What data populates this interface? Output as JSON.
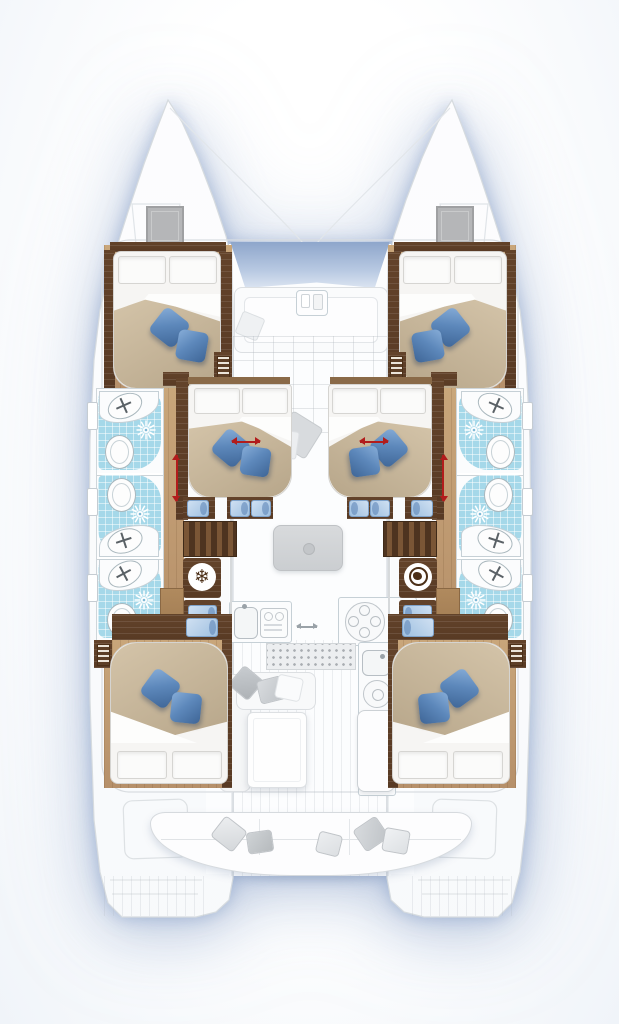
{
  "diagram": {
    "type": "floor-plan",
    "subject": "catamaran-yacht-deck-plan",
    "view": "top-down"
  },
  "palette": {
    "deck_white": "#fcfdfe",
    "outline_gray": "#d5d9dd",
    "shadow_blue": "#7a94c1",
    "wood_light": "#c0996f",
    "wood_dark": "#5d3f27",
    "bathroom_blue": "#a5d8e9",
    "duvet_beige": "#c4b296",
    "pillow_blue": "#5d88bb",
    "step_pad_blue": "#aecbe7",
    "arrow_red": "#b21c1c",
    "front_window_blue": "#93a9cd",
    "faded_furniture_gray": "#d7dadd",
    "hatch_gray": "#b3b4b6"
  },
  "icons": {
    "fridge_glyph": "❄",
    "list": [
      "snowflake-icon",
      "washer-icon",
      "shower-head-icon",
      "sink-faucet-icon",
      "toilet-icon",
      "louver-vent-icon"
    ]
  },
  "counts": {
    "hulls": 2,
    "cabins_with_double_beds": 6,
    "bathrooms": 6,
    "shower_icons": 6,
    "toilets": 6,
    "sinks": 6,
    "blue_pillows_per_bed": 2,
    "red_convert_arrows": 4,
    "companionway_stairs": 2
  },
  "areas": {
    "bow": [
      "port-bow-deck",
      "starboard-bow-deck",
      "trampoline-gap"
    ],
    "forward": [
      "forward-cockpit-lounge",
      "coachroof-front-window"
    ],
    "port_hull": [
      "forward-cabin",
      "three-bathrooms",
      "mid-cabin",
      "stairs",
      "fridge-freezer-cabinet",
      "drawer-cabinet",
      "aft-cabin"
    ],
    "starboard_hull": [
      "forward-cabin",
      "three-bathrooms",
      "mid-cabin",
      "stairs",
      "washer-cabinet",
      "drawer-cabinet",
      "aft-cabin"
    ],
    "saloon": [
      "dinette-table",
      "l-sofa",
      "coffee-table",
      "galley-sink-counter",
      "stove-counter",
      "entry-grate"
    ],
    "aft": [
      "cockpit-bench",
      "port-transom",
      "starboard-transom"
    ]
  }
}
